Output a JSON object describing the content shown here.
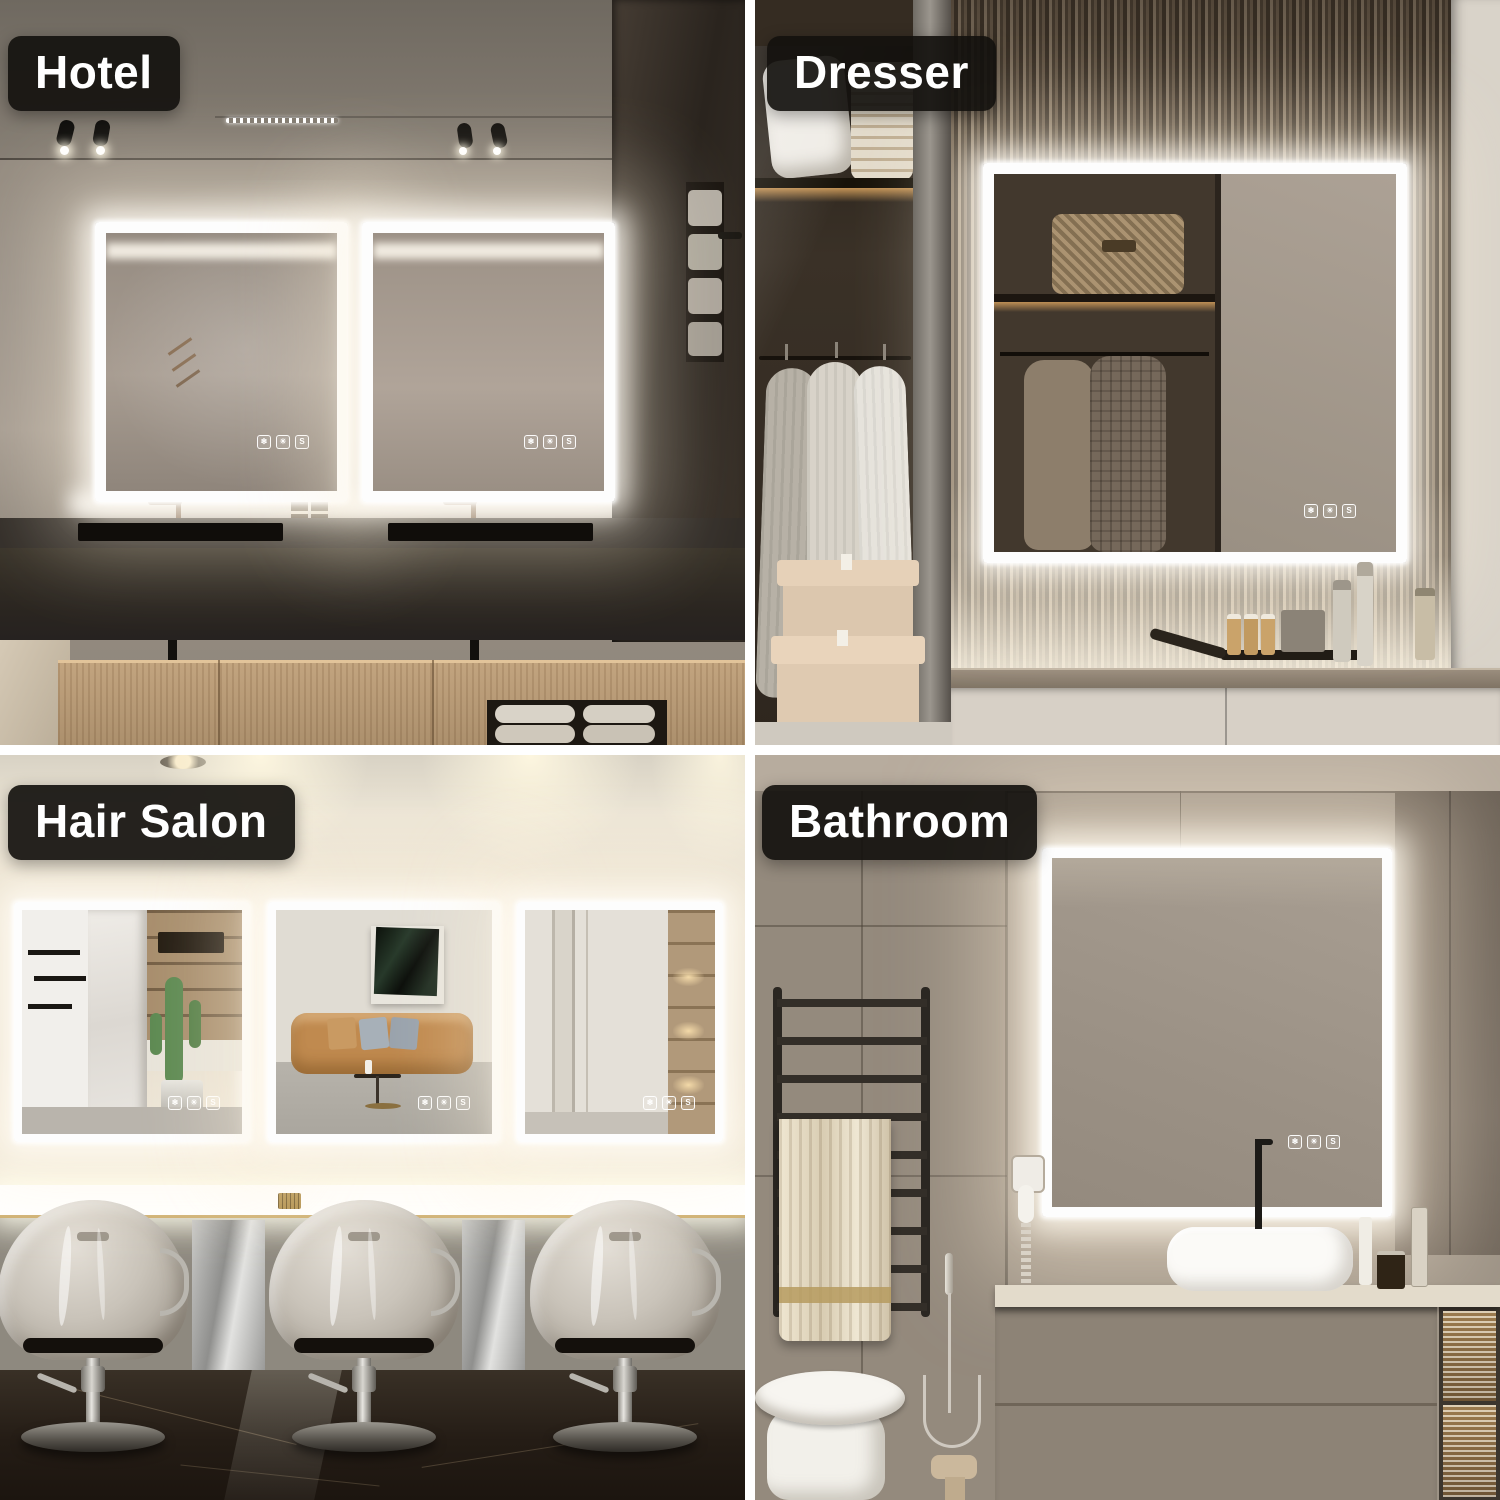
{
  "collage": {
    "divider_color": "#ffffff",
    "badge_style": {
      "background": "#14110e",
      "text_color": "#ffffff"
    },
    "led_glow_color": "#fff6e6",
    "scenes": [
      {
        "id": "hotel",
        "label": "Hotel"
      },
      {
        "id": "dresser",
        "label": "Dresser"
      },
      {
        "id": "hair-salon",
        "label": "Hair Salon"
      },
      {
        "id": "bathroom",
        "label": "Bathroom"
      }
    ],
    "mirror_controls": [
      {
        "name": "defogger",
        "glyph": "❄"
      },
      {
        "name": "brightness",
        "glyph": "☀"
      },
      {
        "name": "memory",
        "glyph": "S"
      }
    ]
  }
}
